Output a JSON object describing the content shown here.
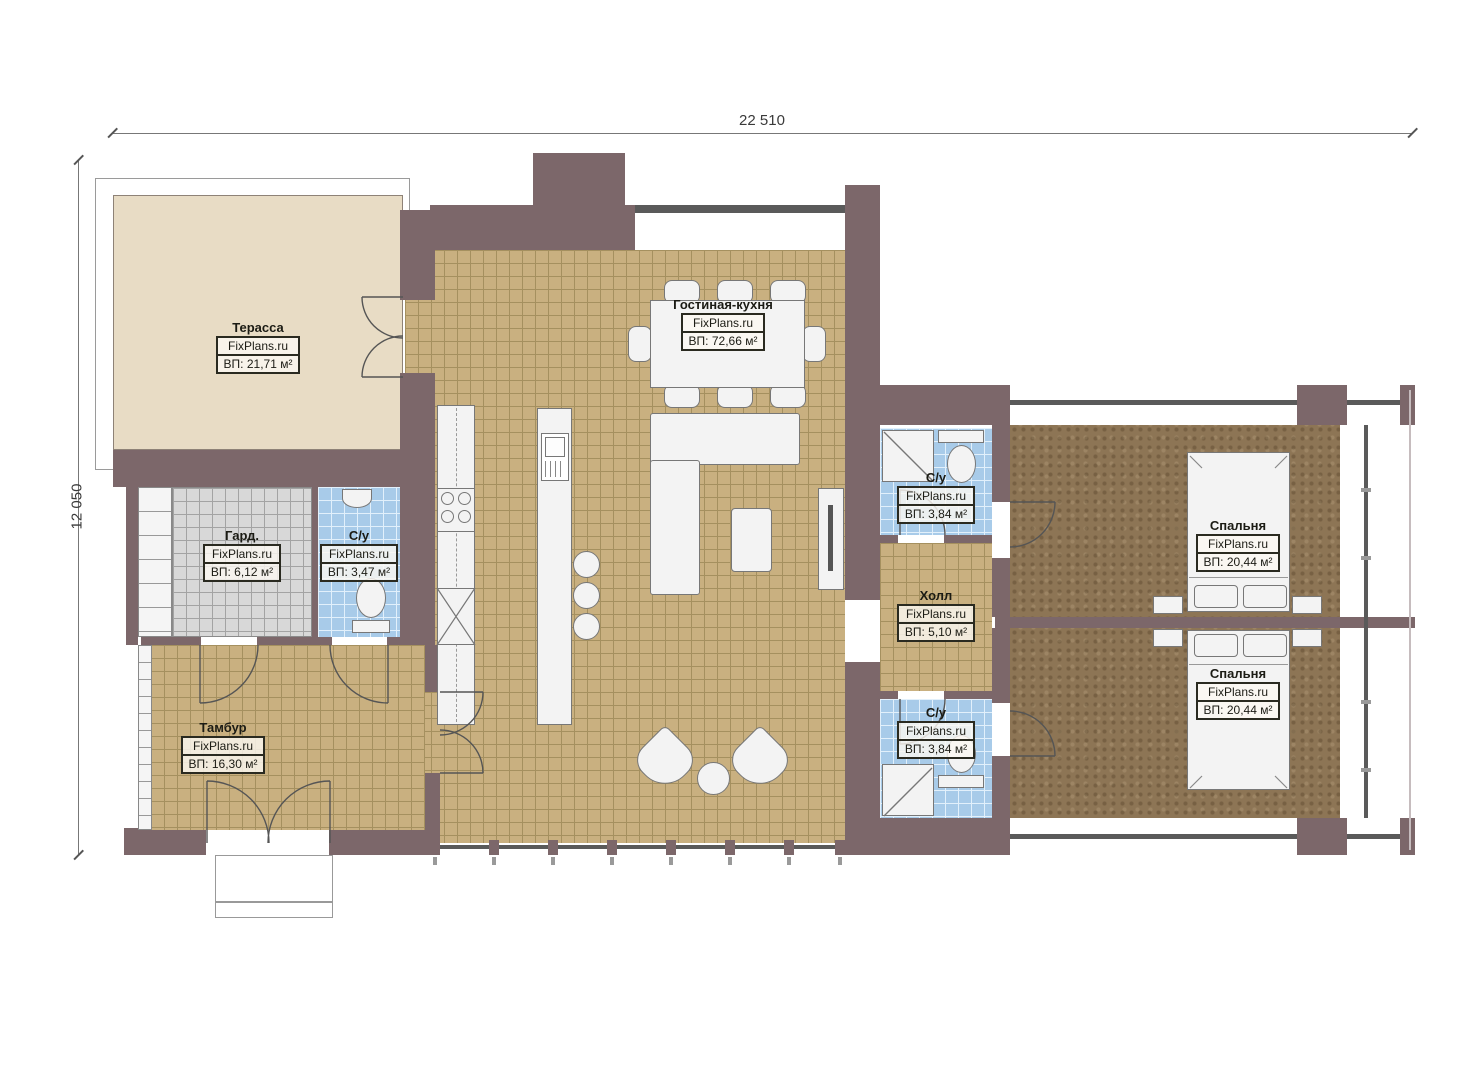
{
  "dimensions": {
    "width_label": "22 510",
    "height_label": "12 050"
  },
  "brand": "FixPlans.ru",
  "rooms": [
    {
      "id": "terrace",
      "name": "Терасса",
      "brand": "FixPlans.ru",
      "area": "ВП: 21,71 м²"
    },
    {
      "id": "living-kitchen",
      "name": "Гостиная-кухня",
      "brand": "FixPlans.ru",
      "area": "ВП: 72,66 м²"
    },
    {
      "id": "wardrobe",
      "name": "Гард.",
      "brand": "FixPlans.ru",
      "area": "ВП: 6,12 м²"
    },
    {
      "id": "bathroom-small",
      "name": "С/у",
      "brand": "FixPlans.ru",
      "area": "ВП: 3,47 м²"
    },
    {
      "id": "tambour",
      "name": "Тамбур",
      "brand": "FixPlans.ru",
      "area": "ВП: 16,30 м²"
    },
    {
      "id": "bathroom-top",
      "name": "С/у",
      "brand": "FixPlans.ru",
      "area": "ВП: 3,84 м²"
    },
    {
      "id": "hall",
      "name": "Холл",
      "brand": "FixPlans.ru",
      "area": "ВП: 5,10 м²"
    },
    {
      "id": "bathroom-bottom",
      "name": "С/у",
      "brand": "FixPlans.ru",
      "area": "ВП: 3,84 м²"
    },
    {
      "id": "bedroom-1",
      "name": "Спальня",
      "brand": "FixPlans.ru",
      "area": "ВП: 20,44 м²"
    },
    {
      "id": "bedroom-2",
      "name": "Спальня",
      "brand": "FixPlans.ru",
      "area": "ВП: 20,44 м²"
    }
  ],
  "colors": {
    "wall": "#7c676a",
    "line": "#5a5a5a",
    "tan_base": "#c9b080",
    "tan_grid": "#a5905f",
    "gray_base": "#d8d8d8",
    "gray_grid": "#a3a3a3",
    "blue_base": "#a8cbe9",
    "blue_grid": "#e2f0fb",
    "brown_base": "#8d7555",
    "terrace_base": "#e8dcc5",
    "fixture": "#f3f3f3",
    "label_border": "#2a2a20"
  }
}
